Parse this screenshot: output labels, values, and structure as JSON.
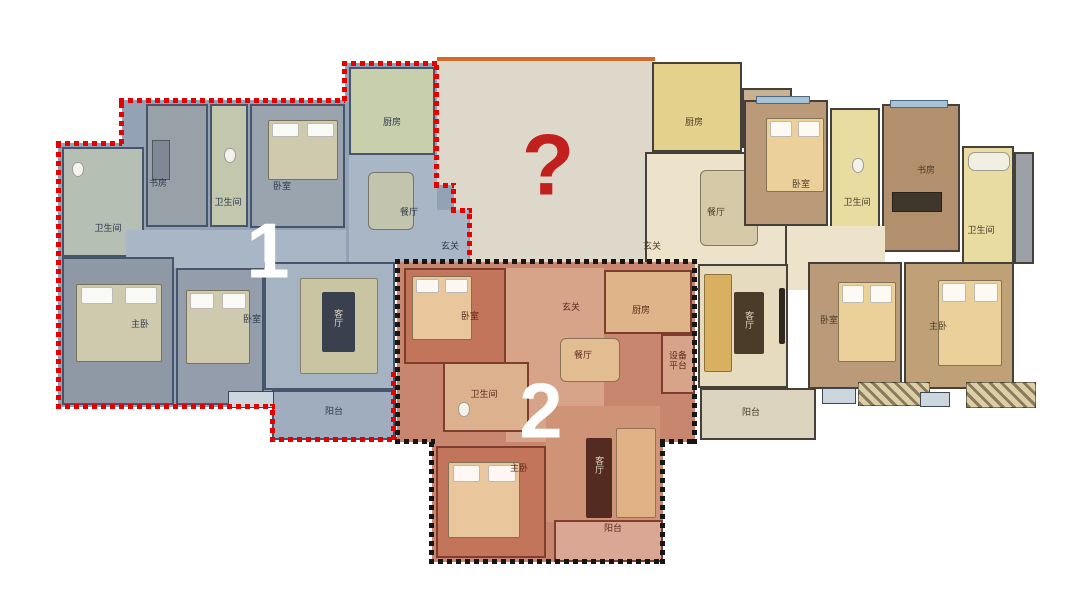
{
  "mystery": {
    "symbol": "?"
  },
  "unit1": {
    "number": "1",
    "rooms": {
      "bath_a": "卫生间",
      "study": "书房",
      "bath_b": "卫生间",
      "bedroom_a": "卧室",
      "kitchen": "厨房",
      "dining": "餐厅",
      "foyer": "玄关",
      "master": "主卧",
      "bedroom_b": "卧室",
      "living": "客厅",
      "balcony": "阳台"
    }
  },
  "unit2": {
    "number": "2",
    "rooms": {
      "bedroom": "卧室",
      "foyer": "玄关",
      "kitchen": "厨房",
      "dining": "餐厅",
      "equipment": "设备平台",
      "bath": "卫生间",
      "master": "主卧",
      "living": "客厅",
      "balcony": "阳台"
    }
  },
  "unit3": {
    "rooms": {
      "kitchen": "厨房",
      "dining": "餐厅",
      "foyer": "玄关",
      "bedroom_a": "卧室",
      "bath_a": "卫生间",
      "study": "书房",
      "bath_b": "卫生间",
      "living": "客厅",
      "balcony": "阳台",
      "bedroom_b": "卧室",
      "master": "主卧"
    }
  },
  "theme": {
    "unit1_outline": "#e60000",
    "unit2_outline": "#161616",
    "unit1_fill": "#93a2b4",
    "unit2_fill": "#c8866e",
    "mystery_bg": "#ded8ca",
    "mystery_top": "#cf6b28",
    "question_color": "#c2201f",
    "number_color": "#ffffff"
  }
}
